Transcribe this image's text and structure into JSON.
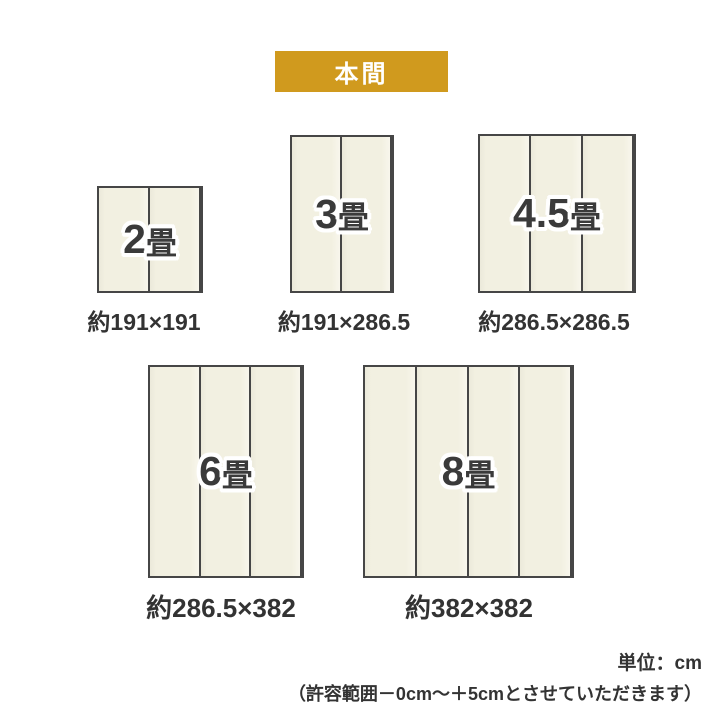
{
  "header": {
    "badge_label": "本間"
  },
  "colors": {
    "badge_bg": "#d09a1e",
    "mat_fill": "#f2f0e1",
    "mat_border": "#464646",
    "label_text": "#3a3a3a",
    "caption_text": "#333333"
  },
  "mats": [
    {
      "name": "2jo",
      "label_number": "2",
      "label_unit": "畳",
      "panels": 2,
      "dimensions": "約191×191"
    },
    {
      "name": "3jo",
      "label_number": "3",
      "label_unit": "畳",
      "panels": 2,
      "dimensions": "約191×286.5"
    },
    {
      "name": "45jo",
      "label_number": "4.5",
      "label_unit": "畳",
      "panels": 3,
      "dimensions": "約286.5×286.5"
    },
    {
      "name": "6jo",
      "label_number": "6",
      "label_unit": "畳",
      "panels": 3,
      "dimensions": "約286.5×382"
    },
    {
      "name": "8jo",
      "label_number": "8",
      "label_unit": "畳",
      "panels": 4,
      "dimensions": "約382×382"
    }
  ],
  "footer": {
    "unit_note": "単位：cm",
    "tolerance_note": "（許容範囲－0cm～＋5cmとさせていただきます）"
  }
}
